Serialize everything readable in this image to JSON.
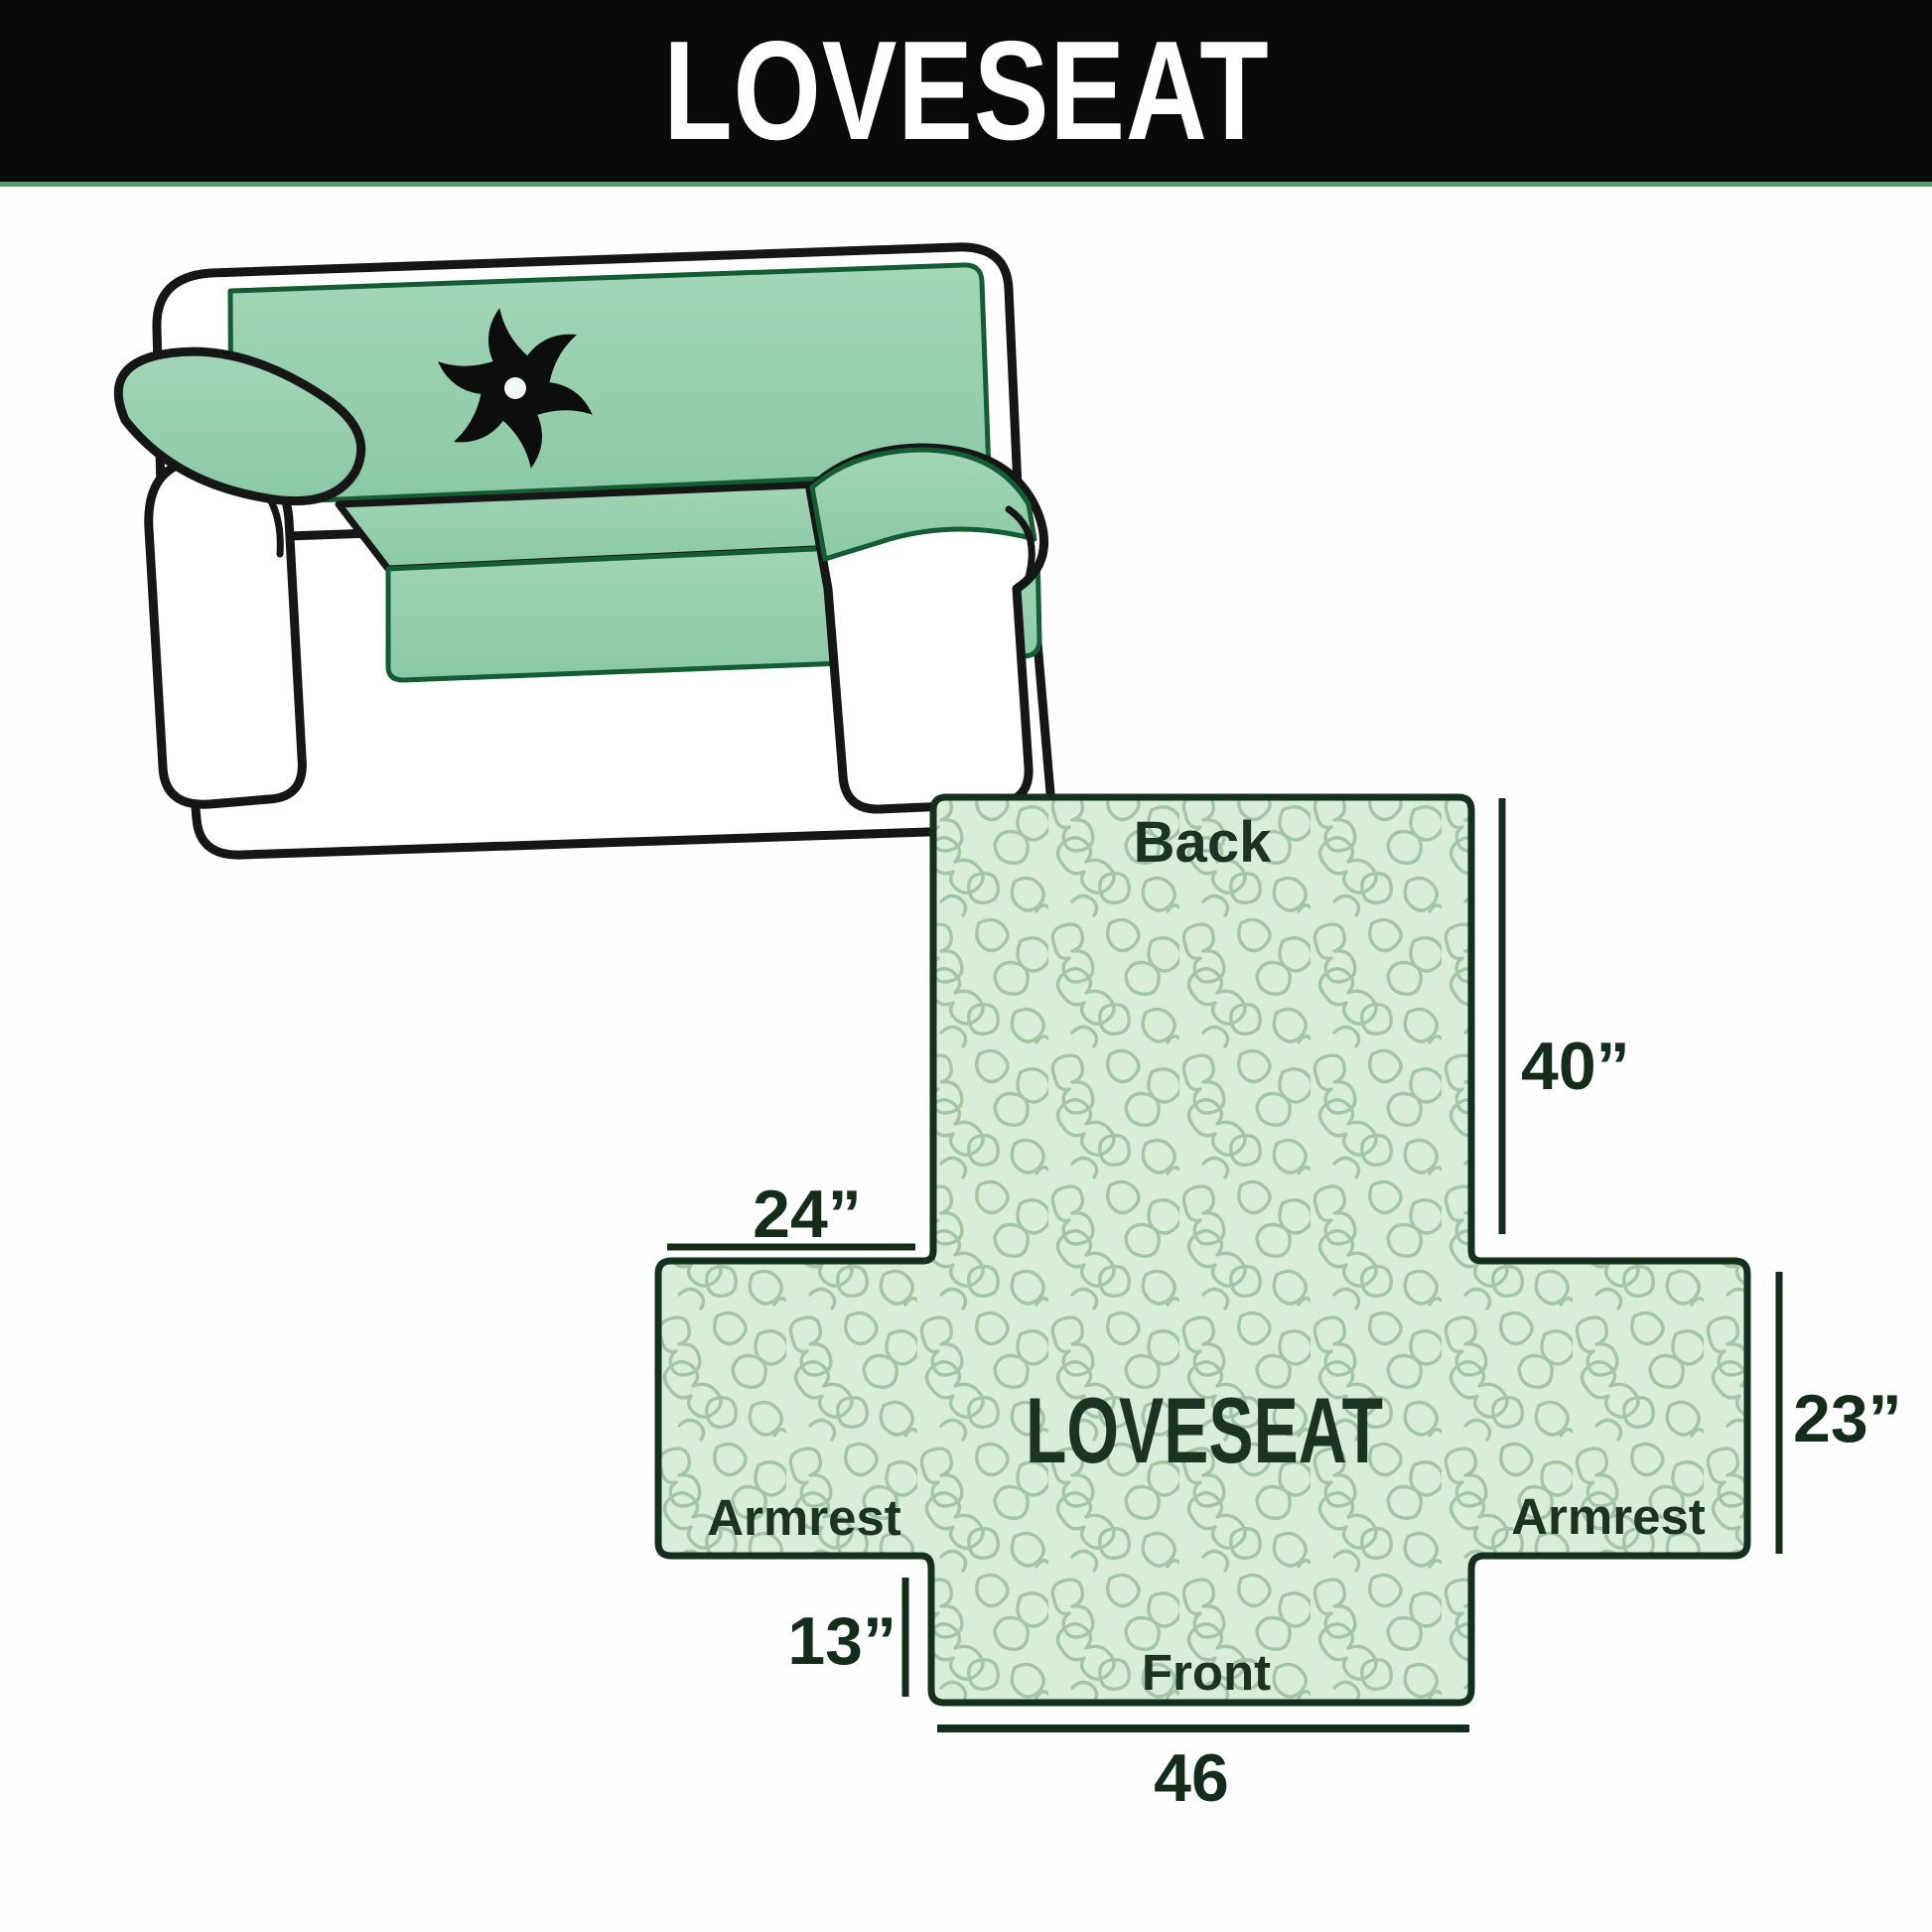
{
  "banner": {
    "title": "LOVESEAT"
  },
  "illustration": {
    "subject": "loveseat sofa with quilted slipcover",
    "logo": "pinwheel",
    "cover_color": "#93cdad",
    "outline_color": "#161616"
  },
  "diagram": {
    "center_label": "LOVESEAT",
    "back_label": "Back",
    "front_label": "Front",
    "armrest_left_label": "Armrest",
    "armrest_right_label": "Armrest",
    "dim_back_height": "40”",
    "dim_armrest_top_width": "24”",
    "dim_armrest_side_height": "23”",
    "dim_front_drop": "13”",
    "dim_front_width": "46",
    "colors": {
      "fill": "#d9eeda",
      "quilt_line": "#a4c5a8",
      "outline": "#12301d",
      "dimension": "#142c1a"
    }
  },
  "page_colors": {
    "banner_bg": "#0a0a0a",
    "banner_text": "#ffffff",
    "banner_accent_line": "#4f9e6c",
    "background": "#fefefe"
  }
}
